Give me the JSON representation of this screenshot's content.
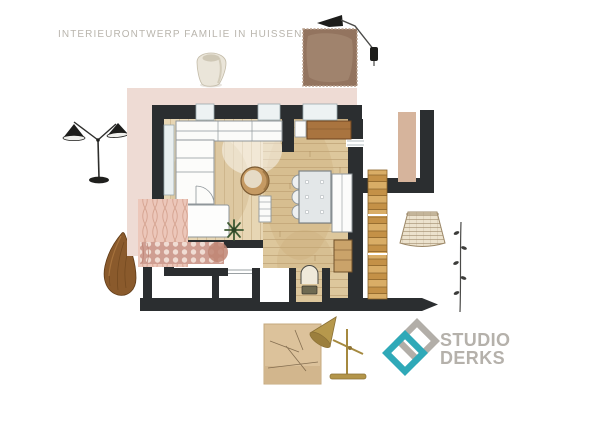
{
  "header": {
    "title": "INTERIEURONTWERP FAMILIE IN HUISSEN",
    "title_color": "#b9b5ad"
  },
  "logo": {
    "line1": "STUDIO",
    "line2": "DERKS",
    "text_color": "#b5b1ab",
    "mark_teal": "#2fa9b8",
    "mark_gray": "#b2aea8"
  },
  "floorplan": {
    "wall_color": "#2b2e30",
    "floor_wood_color": "#ddc79c",
    "accent_pink_band": "#eedbd4",
    "rug_color": "#cf9e92",
    "sideboard_color": "#a9743f",
    "rooms": [
      "living-room",
      "dining-area",
      "hallway",
      "toilet",
      "storage"
    ]
  },
  "moodboard": {
    "items": [
      {
        "name": "ceramic-vase",
        "color": "#e9e4d8"
      },
      {
        "name": "velvet-fabric-swatch",
        "color": "#93745f"
      },
      {
        "name": "black-wall-lamp",
        "color": "#1d1d1b"
      },
      {
        "name": "black-floor-lamp",
        "color": "#1d1d1b"
      },
      {
        "name": "knitted-throw-swatch",
        "color": "#e5bdb0"
      },
      {
        "name": "honeycomb-rug-swatch",
        "color": "#cf9e92"
      },
      {
        "name": "wooden-bowl",
        "color": "#8a5a2c"
      },
      {
        "name": "paint-swatch-beige",
        "color": "#d6b49c"
      },
      {
        "name": "wooden-ladder",
        "color": "#d0a058"
      },
      {
        "name": "rattan-basket-sketch",
        "color": "#9c8868"
      },
      {
        "name": "branch-sketch",
        "color": "#4a4a48"
      },
      {
        "name": "oak-wood-sample",
        "color": "#dcc29b"
      },
      {
        "name": "brass-desk-lamp",
        "color": "#b6984c"
      }
    ]
  }
}
